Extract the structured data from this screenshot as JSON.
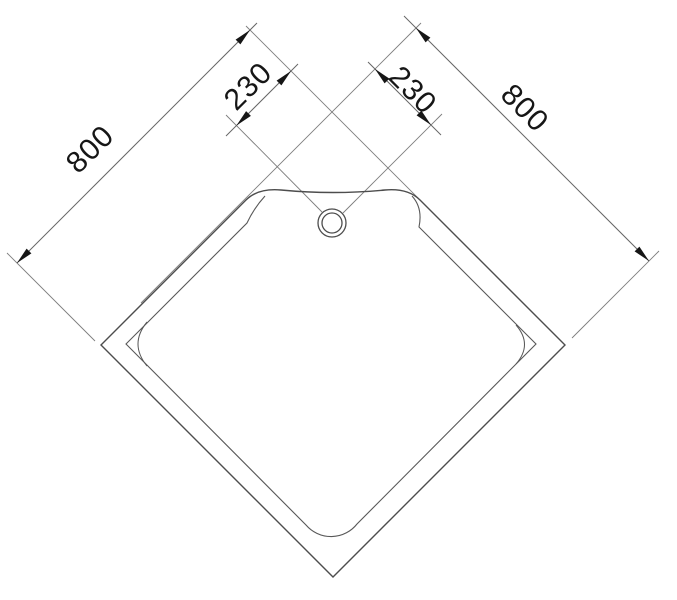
{
  "drawing": {
    "kind": "technical plan drawing",
    "subject": "pentagonal corner shower tray with drain, plan view",
    "colors": {
      "background": "#ffffff",
      "outline": "#4d4d4d",
      "rim_line": "#585858",
      "thin_line": "#7d7d7d",
      "dimension_line": "#666666",
      "arrow_and_text": "#161616"
    },
    "dimensions": [
      {
        "id": "edge-left",
        "label": "800",
        "value": 800
      },
      {
        "id": "cut-left",
        "label": "230",
        "value": 230
      },
      {
        "id": "cut-right",
        "label": "230",
        "value": 230
      },
      {
        "id": "edge-right",
        "label": "800",
        "value": 800
      }
    ],
    "drain": {
      "shape": "double-circle"
    }
  }
}
